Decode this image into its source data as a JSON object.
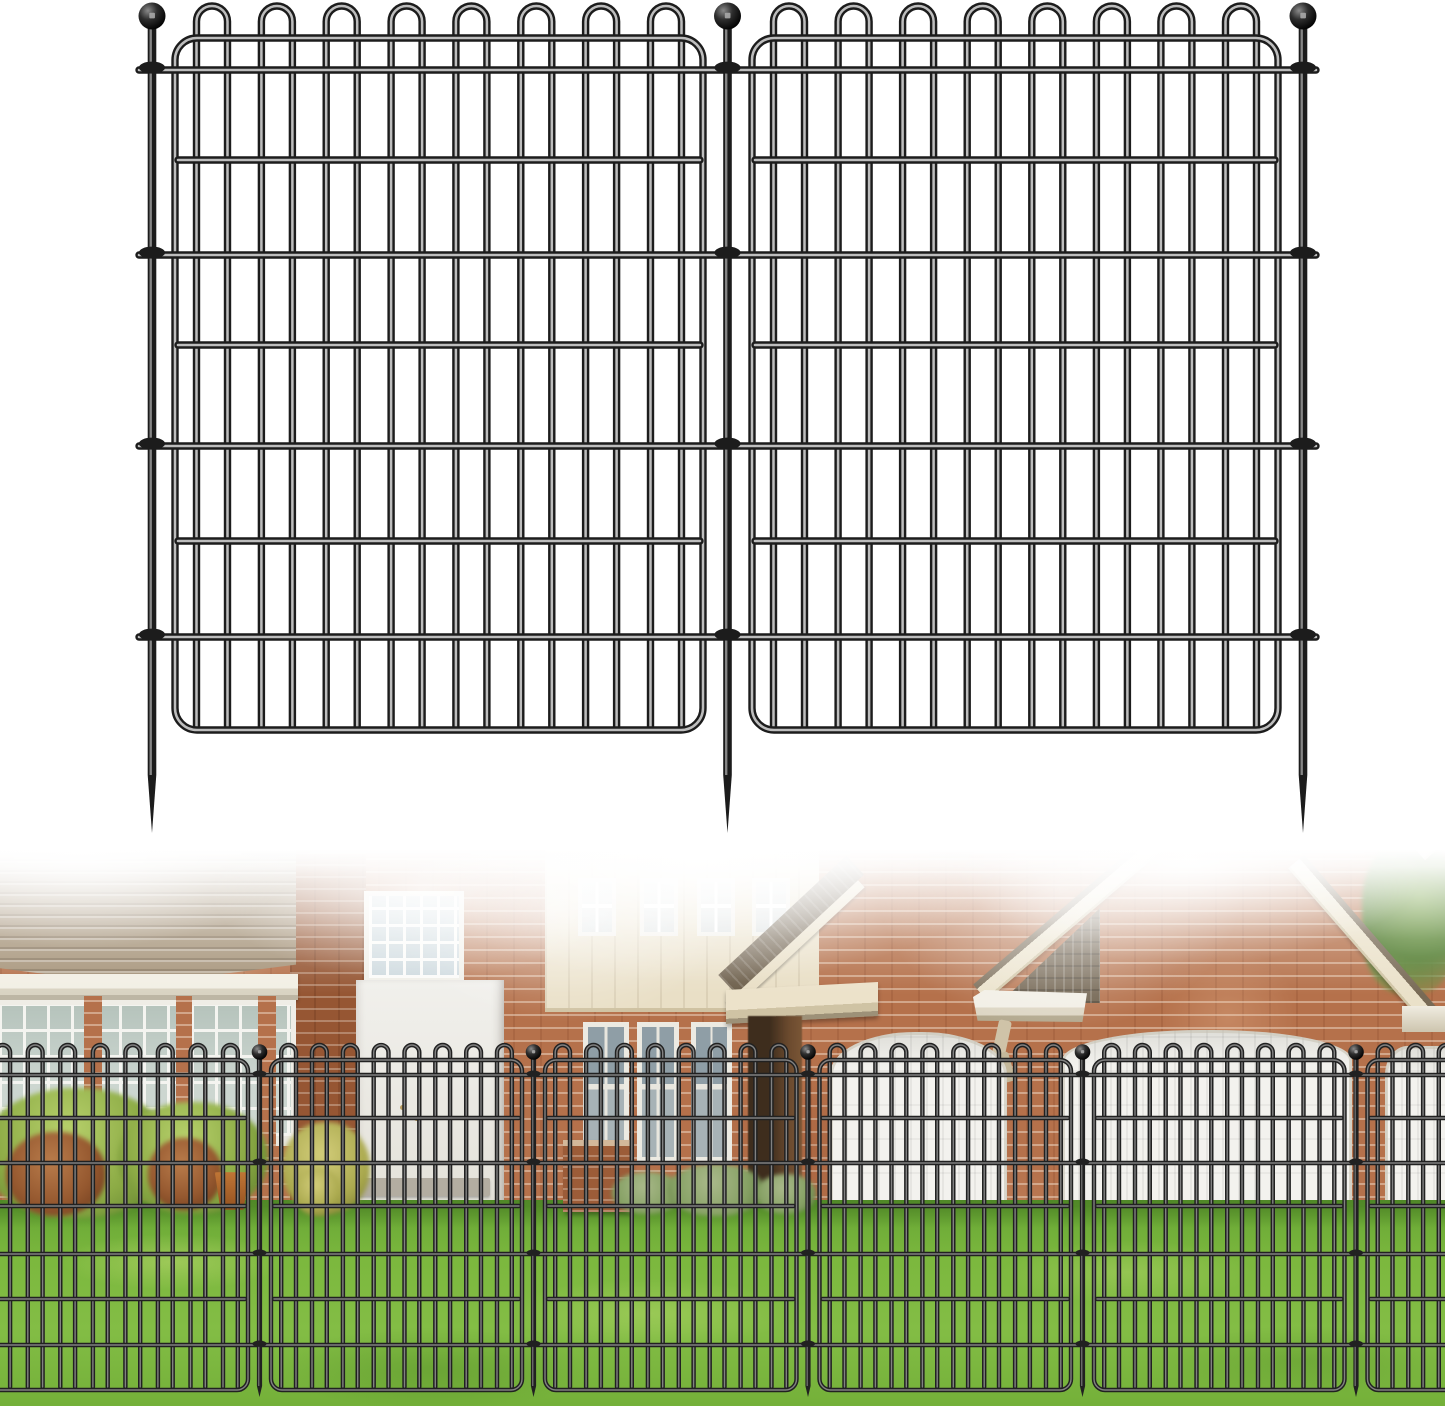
{
  "image_kind": "garden-fence-product-image",
  "colors": {
    "brick": "#b5714b",
    "brick_dark": "#a05f3a",
    "mortar": "#dfc8b2",
    "roof": "#a6947a",
    "cream": "#e9dfc6",
    "glass": "#ccd6d0",
    "door_white": "#f3f2ee",
    "shingle": "#6e604c",
    "grass": "#7cb83e",
    "grass_dark": "#66a534",
    "bush_green": "#8cab45",
    "bush_red": "#95582f",
    "background": "#ffffff"
  },
  "product_fence": {
    "panel_count": 2,
    "stake_count": 3,
    "loops_per_panel": 8,
    "horizontal_wires_per_panel": 7,
    "stroke": {
      "dark": "#1c1c1c",
      "hi": "#cfcfcf",
      "hiRatio": 0.34,
      "hiOpacity": 0.9
    },
    "panels": [
      [
        175,
        703
      ],
      [
        752,
        1278
      ]
    ],
    "stakes": [
      152,
      727.5,
      1303
    ],
    "frame_top": 38,
    "frame_bottom": 730,
    "corner_r": 22,
    "loop_apex": 6,
    "pair_half": 15.5,
    "edge_margin": 37,
    "loop_pitch": 66.1,
    "h_wires": [
      {
        "y": 70,
        "span": "stakes"
      },
      {
        "y": 160,
        "span": "frame"
      },
      {
        "y": 255,
        "span": "stakes"
      },
      {
        "y": 345,
        "span": "frame"
      },
      {
        "y": 446,
        "span": "stakes"
      },
      {
        "y": 541,
        "span": "frame"
      },
      {
        "y": 637,
        "span": "stakes"
      }
    ],
    "x_min": 139,
    "x_max": 1316,
    "wire_w": 7.4,
    "ball": {
      "cy": 16,
      "r": 13.5
    },
    "rod_half": 4.3,
    "taper_y": 775,
    "tip_y": 833,
    "clamp_rx": 13,
    "clamp_ry": 6
  },
  "photo_fence": {
    "panel_count": 6,
    "stake_count": 5,
    "stroke": {
      "dark": "#212121",
      "hi": "#9a9a9a",
      "hiRatio": 0.32,
      "hiOpacity": 0.8
    },
    "panels": [
      [
        -80,
        248
      ],
      [
        271,
        522
      ],
      [
        545,
        796.5
      ],
      [
        819.5,
        1071
      ],
      [
        1094,
        1344.5
      ],
      [
        1367.5,
        1525
      ]
    ],
    "stakes": [
      259.5,
      533.5,
      808,
      1082.5,
      1356
    ],
    "frame_top": 1060,
    "frame_bottom": 1390,
    "corner_r": 11,
    "loop_apex": 1045,
    "pair_half": 7.4,
    "edge_margin": 17.6,
    "loop_pitch": 31.5,
    "h_wires": [
      {
        "y": 1075,
        "span": "stakes"
      },
      {
        "y": 1118,
        "span": "frame"
      },
      {
        "y": 1163,
        "span": "stakes"
      },
      {
        "y": 1206,
        "span": "frame"
      },
      {
        "y": 1254,
        "span": "stakes"
      },
      {
        "y": 1299,
        "span": "frame"
      },
      {
        "y": 1345,
        "span": "stakes"
      }
    ],
    "x_min": -25,
    "x_max": 1470,
    "wire_w": 4.4,
    "ball": {
      "cy": 1052,
      "r": 7.8
    },
    "rod_half": 2.6,
    "taper_y": 1386,
    "tip_y": 1397,
    "clamp_rx": 7,
    "clamp_ry": 3.2
  },
  "scene_regions": [
    "left-roof",
    "roof-gutter",
    "window-row",
    "brick-piers",
    "chimney",
    "glass-block-window",
    "white-entry-door",
    "door-step",
    "cream-siding-panel",
    "upper-windows",
    "lower-windows",
    "porch-roof",
    "porch-soffit",
    "porch-column",
    "gable-trim-bands",
    "shingle-wedge",
    "right-fascia",
    "downspout",
    "garage-door-left",
    "garage-door-right",
    "garage-door-edge",
    "brick-mailbox",
    "bushes",
    "flower-pot",
    "tree-foliage",
    "lawn",
    "fog-overlay"
  ]
}
